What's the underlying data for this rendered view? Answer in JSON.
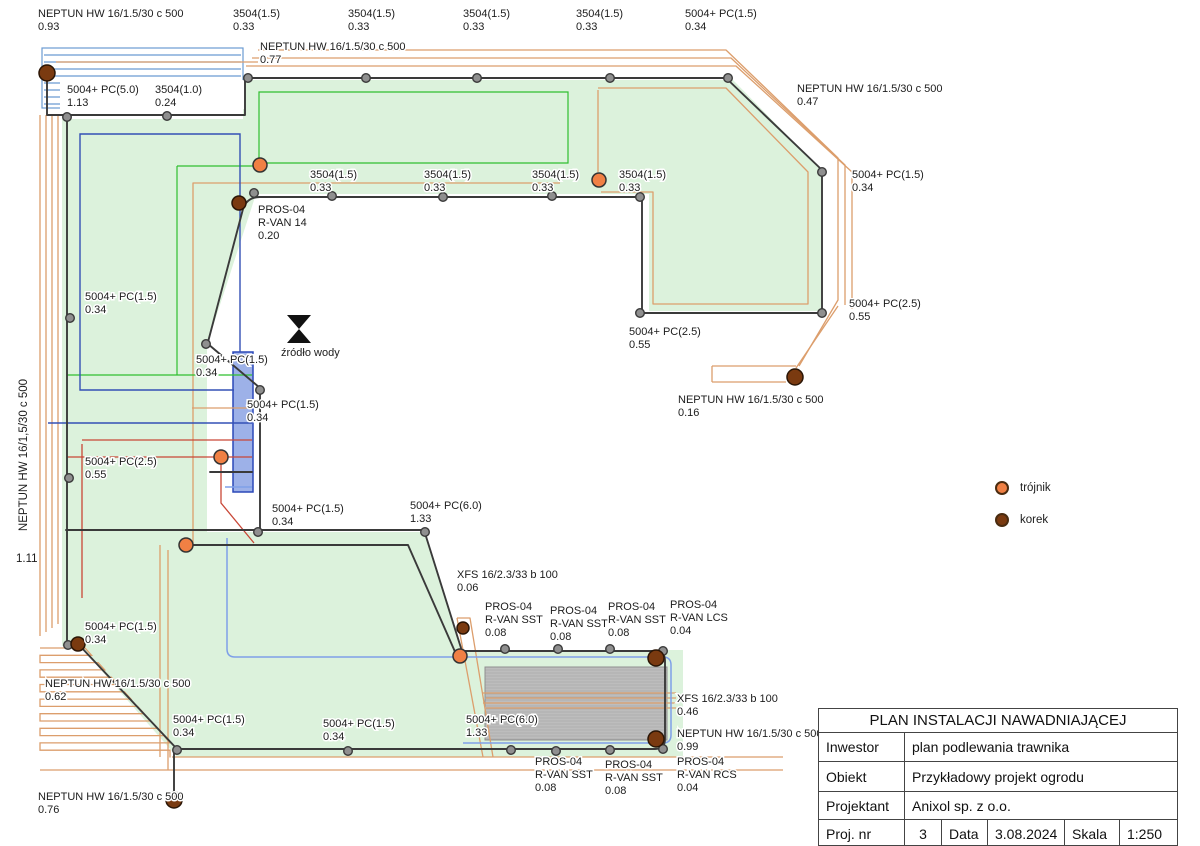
{
  "plan": {
    "left_pipe_label": "NEPTUN HW 16/1,5/30 c 500",
    "left_pipe_value": "1.11",
    "labels": [
      {
        "x": 38,
        "y": 17,
        "lines": [
          "NEPTUN HW 16/1.5/30 c 500",
          "0.93"
        ]
      },
      {
        "x": 233,
        "y": 17,
        "lines": [
          "3504(1.5)",
          "0.33"
        ]
      },
      {
        "x": 348,
        "y": 17,
        "lines": [
          "3504(1.5)",
          "0.33"
        ]
      },
      {
        "x": 463,
        "y": 17,
        "lines": [
          "3504(1.5)",
          "0.33"
        ]
      },
      {
        "x": 576,
        "y": 17,
        "lines": [
          "3504(1.5)",
          "0.33"
        ]
      },
      {
        "x": 685,
        "y": 17,
        "lines": [
          "5004+ PC(1.5)",
          "0.34"
        ]
      },
      {
        "x": 260,
        "y": 50,
        "lines": [
          "NEPTUN HW 16/1.5/30 c 500",
          "0.77"
        ]
      },
      {
        "x": 67,
        "y": 93,
        "lines": [
          "5004+ PC(5.0)",
          "1.13"
        ]
      },
      {
        "x": 155,
        "y": 93,
        "lines": [
          "3504(1.0)",
          "0.24"
        ]
      },
      {
        "x": 797,
        "y": 92,
        "lines": [
          "NEPTUN HW 16/1.5/30 c 500",
          "0.47"
        ]
      },
      {
        "x": 852,
        "y": 178,
        "lines": [
          "5004+ PC(1.5)",
          "0.34"
        ]
      },
      {
        "x": 310,
        "y": 178,
        "lines": [
          "3504(1.5)",
          "0.33"
        ]
      },
      {
        "x": 424,
        "y": 178,
        "lines": [
          "3504(1.5)",
          "0.33"
        ]
      },
      {
        "x": 532,
        "y": 178,
        "lines": [
          "3504(1.5)",
          "0.33"
        ]
      },
      {
        "x": 619,
        "y": 178,
        "lines": [
          "3504(1.5)",
          "0.33"
        ]
      },
      {
        "x": 258,
        "y": 213,
        "lines": [
          "PROS-04",
          "R-VAN 14",
          "0.20"
        ]
      },
      {
        "x": 85,
        "y": 300,
        "lines": [
          "5004+ PC(1.5)",
          "0.34"
        ]
      },
      {
        "x": 849,
        "y": 307,
        "lines": [
          "5004+ PC(2.5)",
          "0.55"
        ]
      },
      {
        "x": 629,
        "y": 335,
        "lines": [
          "5004+ PC(2.5)",
          "0.55"
        ]
      },
      {
        "x": 281,
        "y": 356,
        "lines": [
          "źródło wody"
        ],
        "name": "water-source-label"
      },
      {
        "x": 196,
        "y": 363,
        "lines": [
          "5004+ PC(1.5)",
          "0.34"
        ]
      },
      {
        "x": 247,
        "y": 408,
        "lines": [
          "5004+ PC(1.5)",
          "0.34"
        ]
      },
      {
        "x": 678,
        "y": 403,
        "lines": [
          "NEPTUN HW 16/1.5/30 c 500",
          "0.16"
        ]
      },
      {
        "x": 85,
        "y": 465,
        "lines": [
          "5004+ PC(2.5)",
          "0.55"
        ]
      },
      {
        "x": 272,
        "y": 512,
        "lines": [
          "5004+ PC(1.5)",
          "0.34"
        ]
      },
      {
        "x": 410,
        "y": 509,
        "lines": [
          "5004+ PC(6.0)",
          "1.33"
        ]
      },
      {
        "x": 457,
        "y": 578,
        "lines": [
          "XFS 16/2.3/33 b 100",
          "0.06"
        ]
      },
      {
        "x": 485,
        "y": 610,
        "lines": [
          "PROS-04",
          "R-VAN SST",
          "0.08"
        ]
      },
      {
        "x": 550,
        "y": 614,
        "lines": [
          "PROS-04",
          "R-VAN SST",
          "0.08"
        ]
      },
      {
        "x": 608,
        "y": 610,
        "lines": [
          "PROS-04",
          "R-VAN SST",
          "0.08"
        ]
      },
      {
        "x": 670,
        "y": 608,
        "lines": [
          "PROS-04",
          "R-VAN LCS",
          "0.04"
        ]
      },
      {
        "x": 85,
        "y": 630,
        "lines": [
          "5004+ PC(1.5)",
          "0.34"
        ]
      },
      {
        "x": 45,
        "y": 687,
        "lines": [
          "NEPTUN HW 16/1.5/30 c 500",
          "0.62"
        ]
      },
      {
        "x": 173,
        "y": 723,
        "lines": [
          "5004+ PC(1.5)",
          "0.34"
        ]
      },
      {
        "x": 323,
        "y": 727,
        "lines": [
          "5004+ PC(1.5)",
          "0.34"
        ]
      },
      {
        "x": 466,
        "y": 723,
        "lines": [
          "5004+ PC(6.0)",
          "1.33"
        ]
      },
      {
        "x": 677,
        "y": 702,
        "lines": [
          "XFS 16/2.3/33 b 100",
          "0.46"
        ]
      },
      {
        "x": 677,
        "y": 737,
        "lines": [
          "NEPTUN HW 16/1.5/30 c 500",
          "0.99"
        ]
      },
      {
        "x": 535,
        "y": 765,
        "lines": [
          "PROS-04",
          "R-VAN SST",
          "0.08"
        ]
      },
      {
        "x": 605,
        "y": 768,
        "lines": [
          "PROS-04",
          "R-VAN SST",
          "0.08"
        ]
      },
      {
        "x": 677,
        "y": 765,
        "lines": [
          "PROS-04",
          "R-VAN RCS",
          "0.04"
        ]
      },
      {
        "x": 38,
        "y": 800,
        "lines": [
          "NEPTUN HW 16/1.5/30 c 500",
          "0.76"
        ]
      }
    ]
  },
  "legend": [
    {
      "name": "trojnik",
      "label": "trójnik"
    },
    {
      "name": "korek",
      "label": "korek"
    }
  ],
  "title_block": {
    "title": "PLAN INSTALACJI NAWADNIAJĄCEJ",
    "rows": [
      {
        "label": "Inwestor",
        "value": "plan podlewania trawnika"
      },
      {
        "label": "Obiekt",
        "value": "Przykładowy projekt ogrodu"
      },
      {
        "label": "Projektant",
        "value": "Anixol sp. z o.o."
      }
    ],
    "footer": {
      "proj_label": "Proj. nr",
      "proj_value": "3",
      "data_label": "Data",
      "data_value": "3.08.2024",
      "skala_label": "Skala",
      "skala_value": "1:250"
    }
  },
  "colors": {
    "lawn": "#dcf2dc",
    "pipe_black": "#3a3a3a",
    "pipe_tan": "#dc9e6c",
    "node_gray": "#8f8f8f",
    "trojnik": "#f08044",
    "korek": "#7a3a10",
    "bright_green": "#2fbf2f",
    "dark_blue": "#3350b5",
    "light_blue": "#7e9fe8",
    "red": "#c94737",
    "gray_zone": "#bdbdbd",
    "blue_zone": "#9db1e8"
  }
}
